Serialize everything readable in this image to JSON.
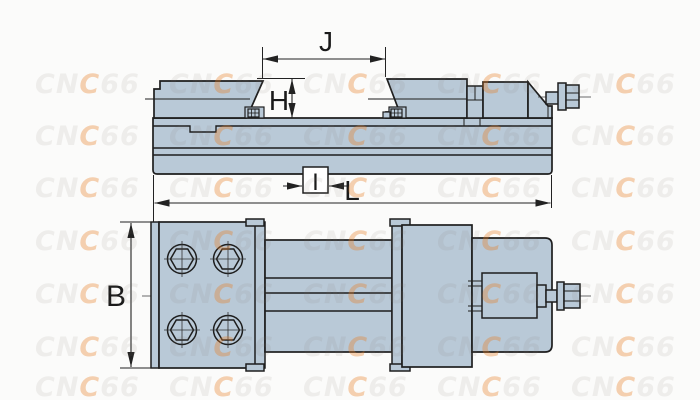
{
  "drawing": {
    "dimensions": {
      "J": "J",
      "H": "H",
      "I": "I",
      "L": "L",
      "B": "B"
    }
  },
  "watermark": {
    "pre": "CN",
    "accent": "C",
    "post": "66",
    "full_text": "CNC66",
    "grid": {
      "col_x": [
        35,
        169,
        303,
        437,
        571
      ],
      "row_baseline_y": [
        93,
        145,
        197,
        250,
        303,
        356,
        396
      ],
      "font_size": 27
    },
    "colors": {
      "gray": "rgba(125,115,105,0.10)",
      "accent": "rgba(232,122,28,0.34)"
    }
  },
  "colors": {
    "background": "#fbfbfa",
    "part_fill": "#b9c9d7",
    "outline": "#1e1e1e",
    "dimension": "#222222"
  }
}
